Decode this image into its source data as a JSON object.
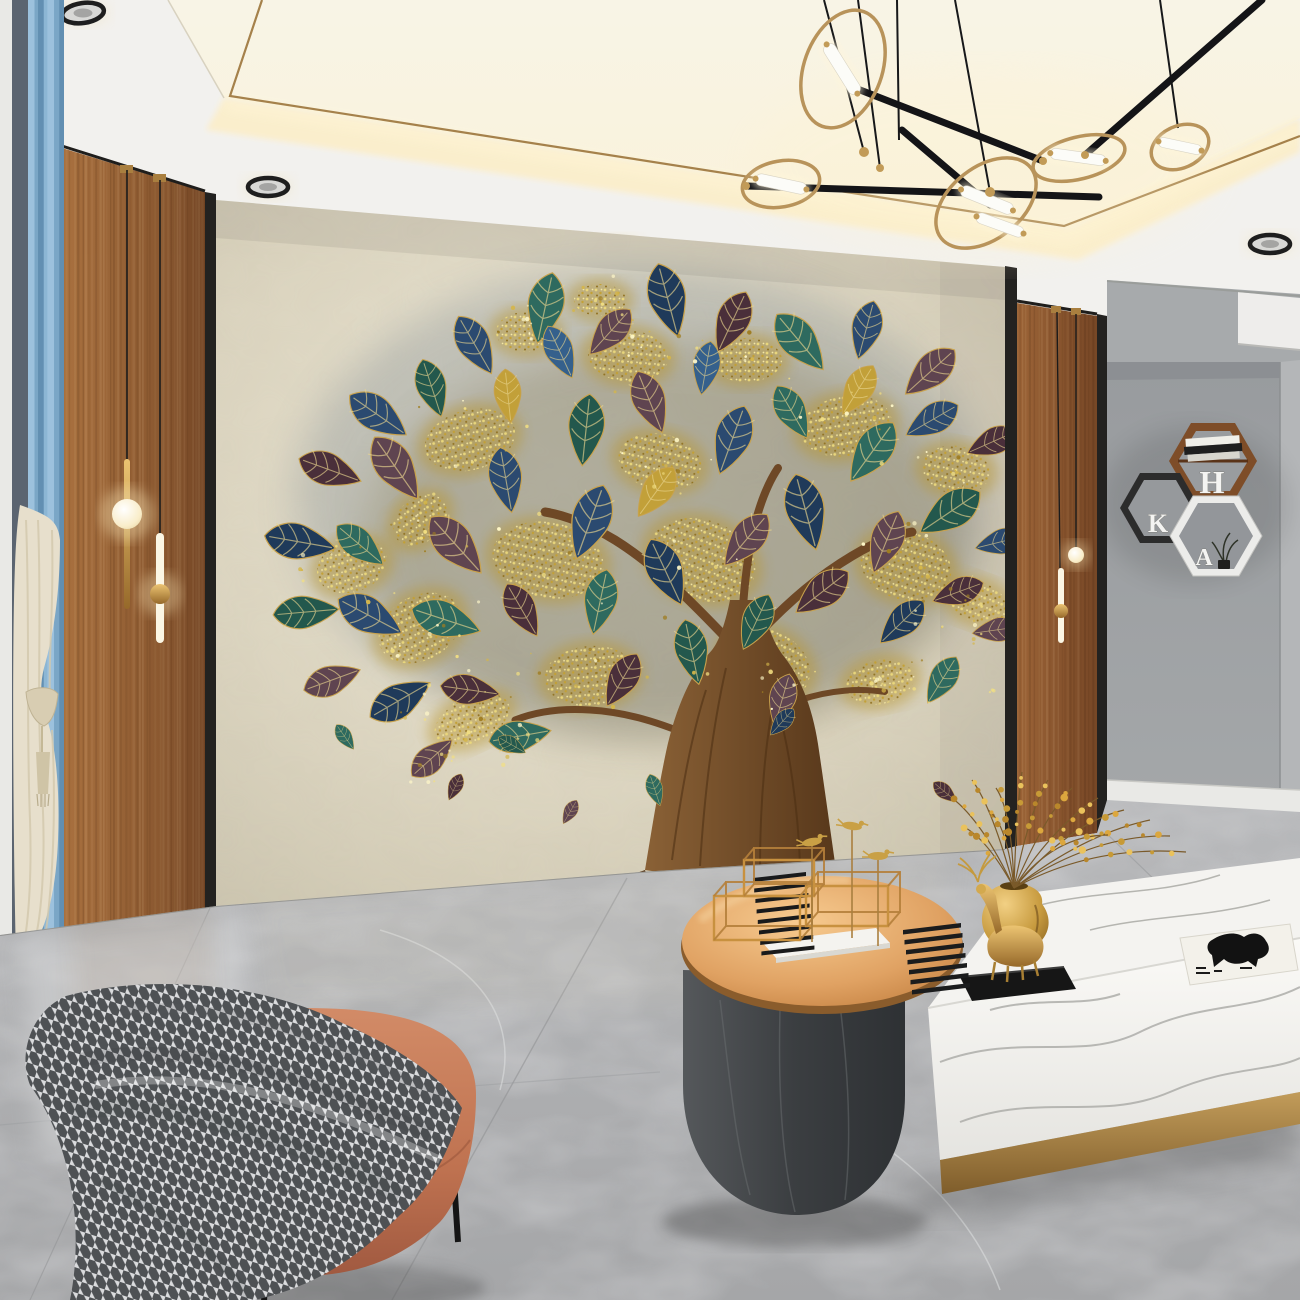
{
  "scene_type": "interior rendering photograph",
  "room": "modern living room with golden tree mural feature wall",
  "shelves": {
    "letters": {
      "top": "H",
      "left": "K",
      "bottom": "A"
    },
    "frame_colors": {
      "top": "brown",
      "left": "black",
      "bottom": "white"
    }
  },
  "counts": {
    "downlights": 4,
    "chandelier_rings": 5,
    "chandelier_tubes": 6,
    "pendant_lights": 4,
    "hex_shelves": 3,
    "falling_leaves": 7
  },
  "palette": {
    "ceiling_white": "#f2f1ee",
    "cove_glow": "#fbeecb",
    "gold_trim": "#a5814b",
    "brass": "#bd9a5e",
    "wood_panel": "#8d5c33",
    "mural_wall": "#dcd5c0",
    "leaf_navy": "#2b4a70",
    "leaf_teal": "#2e6a5f",
    "leaf_plum": "#5f4450",
    "leaf_gold": "#c2a039",
    "trunk_brown": "#6b4524",
    "accent_wall_gray": "#a7aaac",
    "floor_gray": "#b0b1b3",
    "curtain_blue": "#8db4d6",
    "curtain_cream": "#e7dfcc",
    "ottoman_coral": "#c47a5b",
    "throw_gray": "#d9dadc",
    "table_rosegold": "#dd9a5d",
    "table_base": "#3f4244",
    "cabinet_white": "#f2f1ee",
    "deer_gold": "#c9972f",
    "berry_yellow": "#dca73e"
  },
  "objects": [
    "ring-chandelier",
    "recessed-downlights",
    "cove-lighting",
    "window-frame",
    "blue-curtain",
    "sheer-curtain",
    "curtain-tassel",
    "wood-panel-left",
    "wood-panel-right",
    "pendant-sphere-light",
    "pendant-tube-light",
    "tree-mural",
    "gold-glitter-foliage",
    "falling-leaves",
    "hexagon-wall-shelves",
    "marble-floor",
    "coral-ottoman",
    "houndstooth-throw",
    "rose-gold-coffee-table",
    "wireframe-decor",
    "slat-sculptures",
    "bird-sculptures",
    "white-marble-cabinet",
    "gold-deer-figurine",
    "gold-vase-with-berries",
    "horse-art-book",
    "white-baseboard"
  ]
}
